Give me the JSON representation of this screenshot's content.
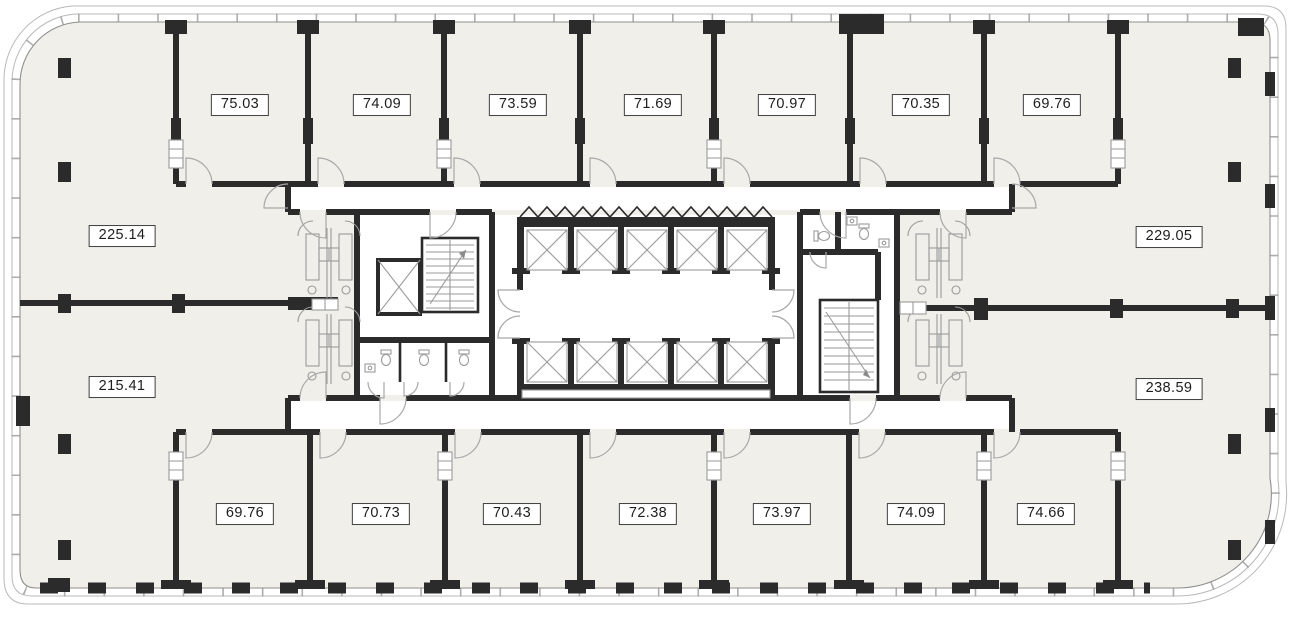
{
  "plan": {
    "type": "office-floor-plan",
    "colors": {
      "wall": "#2b2b2b",
      "floor": "#f0efe9",
      "line": "#9a9a9a",
      "glass": "#b9b9b9",
      "door": "#a8a8a8",
      "background": "#ffffff",
      "label_border": "#3f3f3f",
      "label_text": "#1d1d1d"
    },
    "rooms": {
      "top": [
        {
          "area": "75.03"
        },
        {
          "area": "74.09"
        },
        {
          "area": "73.59"
        },
        {
          "area": "71.69"
        },
        {
          "area": "70.97"
        },
        {
          "area": "70.35"
        },
        {
          "area": "69.76"
        }
      ],
      "left": [
        {
          "area": "225.14"
        },
        {
          "area": "215.41"
        }
      ],
      "right": [
        {
          "area": "229.05"
        },
        {
          "area": "238.59"
        }
      ],
      "bottom": [
        {
          "area": "69.76"
        },
        {
          "area": "70.73"
        },
        {
          "area": "70.43"
        },
        {
          "area": "72.38"
        },
        {
          "area": "73.97"
        },
        {
          "area": "74.09"
        },
        {
          "area": "74.66"
        }
      ]
    },
    "core": {
      "elevator_shafts": 10,
      "service_elevator": 1,
      "stairwells": 2,
      "wc_blocks": 4
    }
  }
}
